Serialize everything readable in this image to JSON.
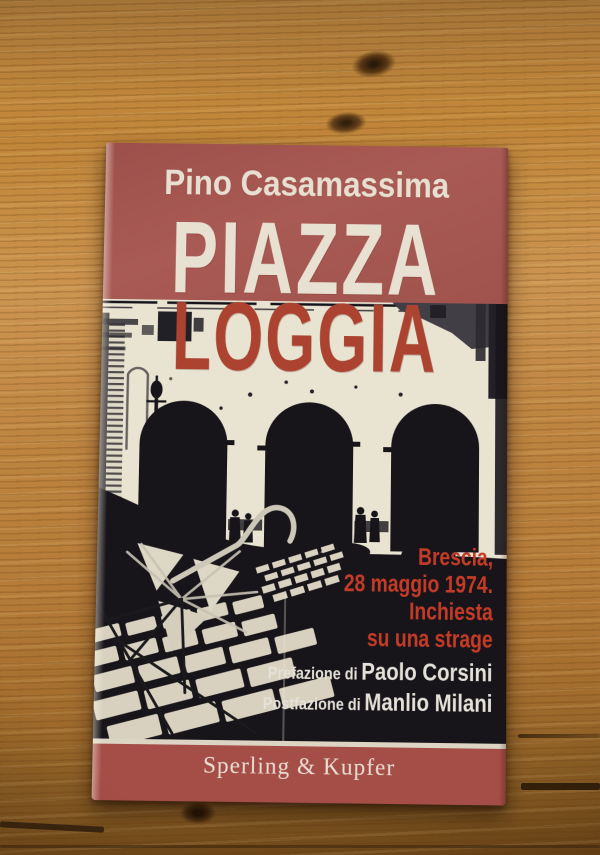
{
  "scene": {
    "description": "Paperback book photographed lying on a warm pine wooden table",
    "table_wood_color": "#bd8440"
  },
  "book": {
    "author": "Pino Casamassima",
    "title": {
      "line1": "PIAZZA",
      "line2": "LOGGIA"
    },
    "subtitle_lines": [
      "Brescia,",
      "28 maggio 1974.",
      "Inchiesta",
      "su una strage"
    ],
    "preface_label": "Prefazione di",
    "preface_name": "Paolo Corsini",
    "postface_label": "Postfazione di",
    "postface_name": "Manlio Milani",
    "publisher": "Sperling & Kupfer",
    "cover_photo": {
      "description": "High-contrast black-and-white photo of Piazza della Loggia: arcade with three dark arches, lamppost, crowd silhouettes, cobblestone pavement and the skeleton of a broken umbrella in the foreground"
    },
    "colors": {
      "cover_red": "#a3544f",
      "band_red": "#a54e47",
      "title_red": "#ac4331",
      "subtitle_red": "#c53b27",
      "cream": "#e9e3d2",
      "photo_black": "#17151a"
    }
  }
}
